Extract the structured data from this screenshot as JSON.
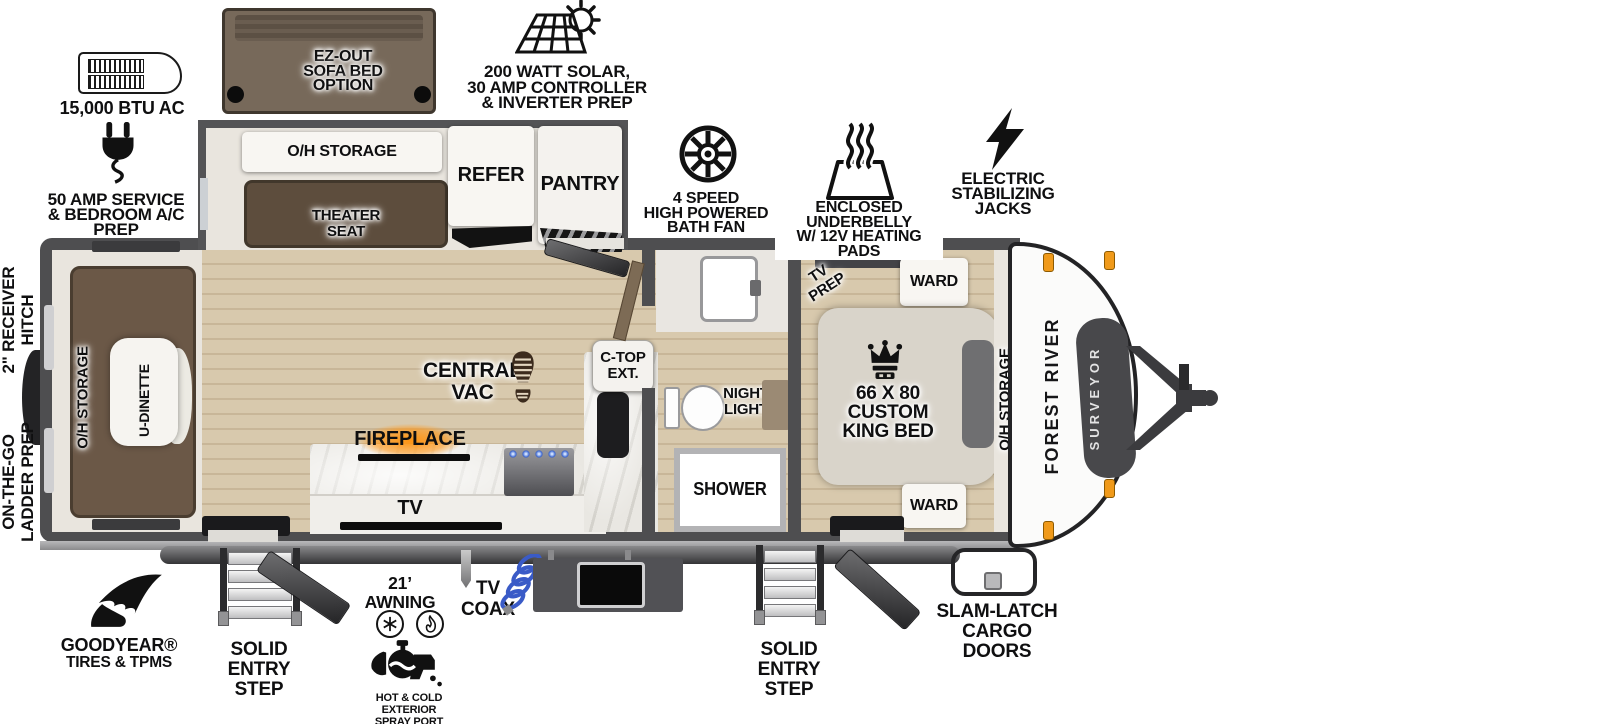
{
  "callouts": {
    "ac": {
      "label": "15,000 BTU AC"
    },
    "sofa": {
      "lines": [
        "EZ-OUT",
        "SOFA BED",
        "OPTION"
      ]
    },
    "solar": {
      "lines": [
        "200 WATT SOLAR,",
        "30 AMP CONTROLLER",
        "& INVERTER PREP"
      ]
    },
    "service": {
      "lines": [
        "50 AMP SERVICE",
        "& BEDROOM A/C PREP"
      ]
    },
    "fan": {
      "lines": [
        "4 SPEED",
        "HIGH POWERED",
        "BATH FAN"
      ]
    },
    "underbelly": {
      "lines": [
        "ENCLOSED UNDERBELLY",
        "W/ 12V HEATING PADS"
      ]
    },
    "jacks": {
      "lines": [
        "ELECTRIC",
        "STABILIZING",
        "JACKS"
      ]
    },
    "receiver_hitch": {
      "lines": [
        "2\" RECEIVER",
        "HITCH"
      ]
    },
    "ladder_prep": {
      "lines": [
        "ON-THE-GO",
        "LADDER PREP"
      ]
    }
  },
  "fp": {
    "slideout": {
      "oh_storage": "O/H STORAGE",
      "theater": {
        "lines": [
          "THEATER",
          "SEAT"
        ]
      },
      "refer": "REFER",
      "pantry": "PANTRY"
    },
    "rear": {
      "oh_storage": "O/H STORAGE",
      "u_dinette": "U-DINETTE"
    },
    "living": {
      "central_vac": {
        "lines": [
          "CENTRAL",
          "VAC"
        ]
      },
      "fireplace": "FIREPLACE",
      "tv": "TV",
      "ctop": {
        "lines": [
          "C-TOP",
          "EXT."
        ]
      }
    },
    "bath": {
      "night_light": {
        "lines": [
          "NIGHT",
          "LIGHT"
        ]
      },
      "shower": "SHOWER"
    },
    "bedroom": {
      "tv_prep": {
        "lines": [
          "TV",
          "PREP"
        ]
      },
      "ward_top": "WARD",
      "bed": {
        "lines": [
          "66 X 80",
          "CUSTOM",
          "KING BED"
        ]
      },
      "oh_storage": "O/H STORAGE",
      "ward_bottom": "WARD"
    },
    "brand": {
      "make": "FOREST RIVER",
      "model": "SURVEYOR"
    }
  },
  "bottom": {
    "goodyear": {
      "line1": "GOODYEAR®",
      "line2": "TIRES & TPMS"
    },
    "step1": {
      "lines": [
        "SOLID ENTRY",
        "STEP"
      ]
    },
    "awning": "21’ AWNING",
    "coax": {
      "lines": [
        "TV",
        "COAX"
      ]
    },
    "spray": {
      "lines": [
        "HOT & COLD EXTERIOR",
        "SPRAY PORT"
      ]
    },
    "step2": {
      "lines": [
        "SOLID ENTRY",
        "STEP"
      ]
    },
    "cargo": {
      "lines": [
        "SLAM-LATCH",
        "CARGO DOORS"
      ]
    }
  },
  "colors": {
    "wall": "#4e4e50",
    "floor": "#d8c9ad",
    "furniture_brown": "#6b5847",
    "marble": "#e9e7e2",
    "fireplace_glow": "#ff9514",
    "coax_blue": "#3a5bc7",
    "marker_light_orange": "#f09a1a"
  }
}
